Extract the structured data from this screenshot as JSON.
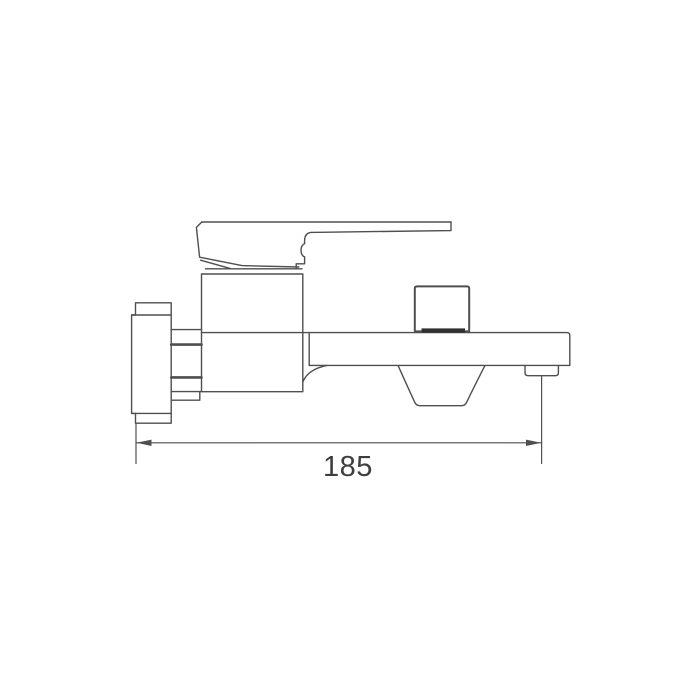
{
  "drawing": {
    "type": "technical-line-drawing",
    "subject": "wall-mounted single-lever bath mixer faucet, side elevation",
    "background_color": "#ffffff",
    "line_color": "#4f4f4f",
    "dark_band_color": "#2f2f2f",
    "text_color": "#3d3d3d",
    "dimension": {
      "value": "185"
    },
    "components": [
      "wall-flange",
      "mounting-connector",
      "mixer-body",
      "lever-handle",
      "bonnet-ring",
      "diverter-knob",
      "spout",
      "underside-scoop",
      "aerator-outlet",
      "dimension-line"
    ]
  }
}
